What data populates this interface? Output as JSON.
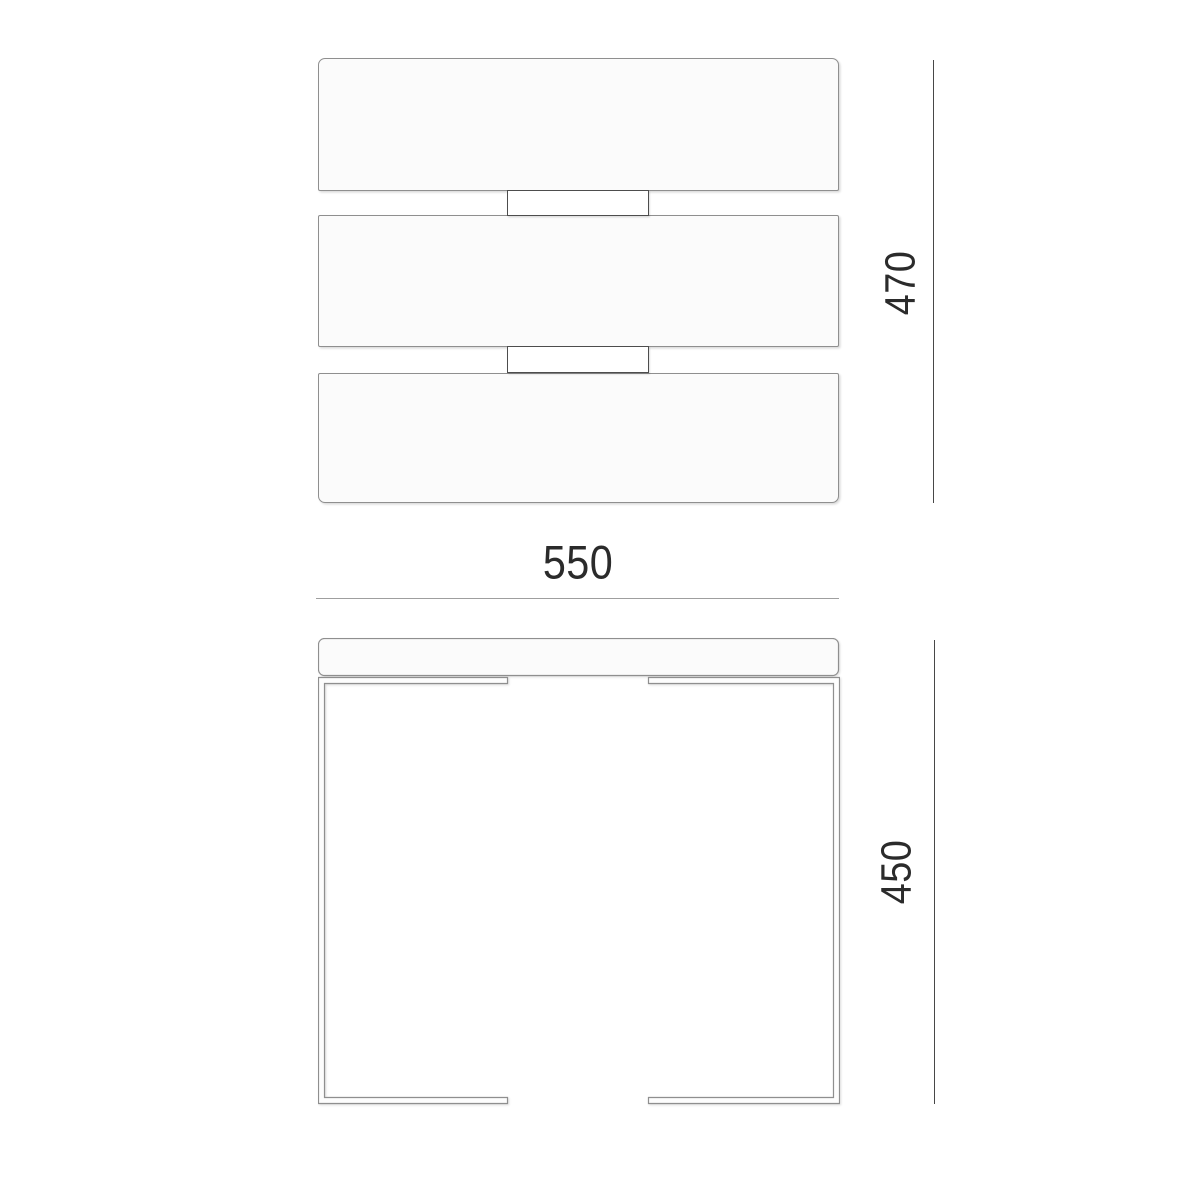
{
  "dimensions": {
    "width": {
      "label": "550"
    },
    "height": {
      "label": "470"
    },
    "depth": {
      "label": "450"
    }
  },
  "front_view": {
    "drawer_panels": 3,
    "handles": 2
  },
  "colors": {
    "background": "#ffffff",
    "outline": "#8f8f8f",
    "handle_outline": "#4d4d4d",
    "dimension_line_dark": "#474747",
    "dimension_line_light": "#9f9f9f",
    "label_text": "#2b2b2b",
    "panel_fill": "#fbfbfb"
  }
}
